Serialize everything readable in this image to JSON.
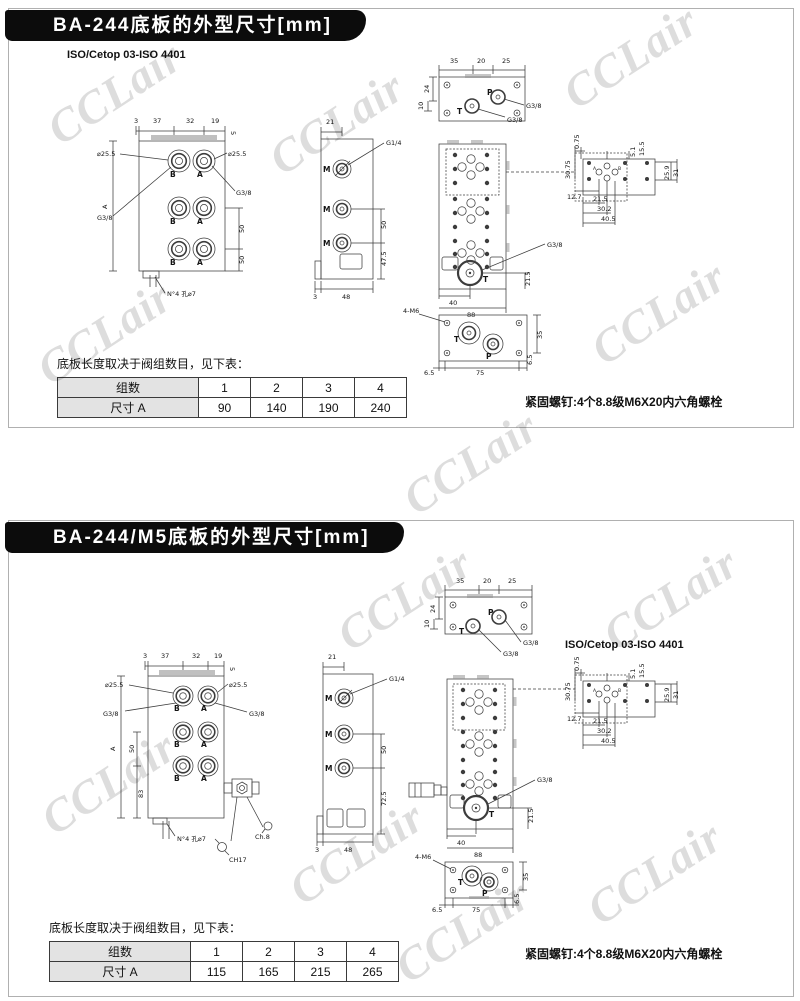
{
  "page": {
    "watermark": "CCLair"
  },
  "sections": [
    {
      "title": "BA-244底板的外型尺寸[mm]",
      "iso_label": "ISO/Cetop 03-ISO 4401",
      "note": "底板长度取决于阀组数目，见下表：",
      "screw_note": "紧固螺钉:4个8.8级M6X20内六角螺栓",
      "table": {
        "row1_header": "组数",
        "row1_values": [
          "1",
          "2",
          "3",
          "4"
        ],
        "row2_header": "尺寸 A",
        "row2_values": [
          "90",
          "140",
          "190",
          "240"
        ]
      },
      "front_view": {
        "top_dims": [
          "3",
          "37",
          "32",
          "19",
          "5"
        ],
        "dia_left": "⌀25.5",
        "dia_right": "⌀25.5",
        "g_left": "G3/8",
        "g_right": "G3/8",
        "a_label": "A",
        "right_dims": [
          "50",
          "50"
        ],
        "port_labels": [
          "B",
          "A",
          "B",
          "A",
          "B",
          "A"
        ],
        "bottom_label": "N°4 孔⌀7"
      },
      "side_view": {
        "top_dim": "21",
        "port_label": "M",
        "thread_label": "G1/4",
        "right_dims": [
          "50",
          "47.5"
        ],
        "bottom_dims": [
          "3",
          "48"
        ]
      },
      "end_view": {
        "top_dims": [
          "35",
          "20",
          "25"
        ],
        "left_dims": [
          "24",
          "10"
        ],
        "port_p": "P",
        "port_t": "T",
        "thread_labels": [
          "G3/8",
          "G3/8"
        ]
      },
      "plan_view": {
        "thread_label": "G3/8",
        "port_t": "T",
        "bottom_dims": [
          "40",
          "88"
        ],
        "right_dim": "21.5"
      },
      "bottom_view": {
        "screw_label": "4-M6",
        "port_t": "T",
        "port_p": "P",
        "dims": [
          "6.5",
          "75",
          "6.5",
          "35"
        ]
      },
      "detail_view": {
        "port_a": "A",
        "port_b": "B",
        "dims": [
          "0.75",
          "30.75",
          "5.1",
          "15.5",
          "25.9",
          "31",
          "12.7",
          "21.5",
          "30.2",
          "40.5"
        ]
      }
    },
    {
      "title": "BA-244/M5底板的外型尺寸[mm]",
      "iso_label": "ISO/Cetop 03-ISO 4401",
      "note": "底板长度取决于阀组数目，见下表：",
      "screw_note": "紧固螺钉:4个8.8级M6X20内六角螺栓",
      "table": {
        "row1_header": "组数",
        "row1_values": [
          "1",
          "2",
          "3",
          "4"
        ],
        "row2_header": "尺寸 A",
        "row2_values": [
          "115",
          "165",
          "215",
          "265"
        ]
      },
      "front_view": {
        "top_dims": [
          "3",
          "37",
          "32",
          "19",
          "5"
        ],
        "dia_left": "⌀25.5",
        "dia_right": "⌀25.5",
        "g_left": "G3/8",
        "g_right": "G3/8",
        "a_label": "A",
        "inner_dims": [
          "50",
          "83"
        ],
        "port_labels": [
          "B",
          "A",
          "B",
          "A",
          "B",
          "A"
        ],
        "bottom_label": "N°4 孔⌀7",
        "hex_labels": [
          "Ch.8",
          "CH17"
        ]
      },
      "side_view": {
        "top_dim": "21",
        "port_label": "M",
        "thread_label": "G1/4",
        "right_dims": [
          "50",
          "72.5"
        ],
        "bottom_dims": [
          "3",
          "48"
        ]
      },
      "end_view": {
        "top_dims": [
          "35",
          "20",
          "25"
        ],
        "left_dims": [
          "24",
          "10"
        ],
        "port_p": "P",
        "port_t": "T",
        "thread_labels": [
          "G3/8",
          "G3/8"
        ]
      },
      "plan_view": {
        "thread_label": "G3/8",
        "port_t": "T",
        "bottom_dims": [
          "40",
          "88"
        ],
        "right_dim": "21.5"
      },
      "bottom_view": {
        "screw_label": "4-M6",
        "port_t": "T",
        "port_p": "P",
        "dims": [
          "6.5",
          "75",
          "6.5",
          "35"
        ]
      },
      "detail_view": {
        "port_a": "A",
        "port_b": "B",
        "dims": [
          "0.75",
          "30.75",
          "5.1",
          "15.5",
          "25.9",
          "31",
          "12.7",
          "21.5",
          "30.2",
          "40.5"
        ]
      }
    }
  ]
}
